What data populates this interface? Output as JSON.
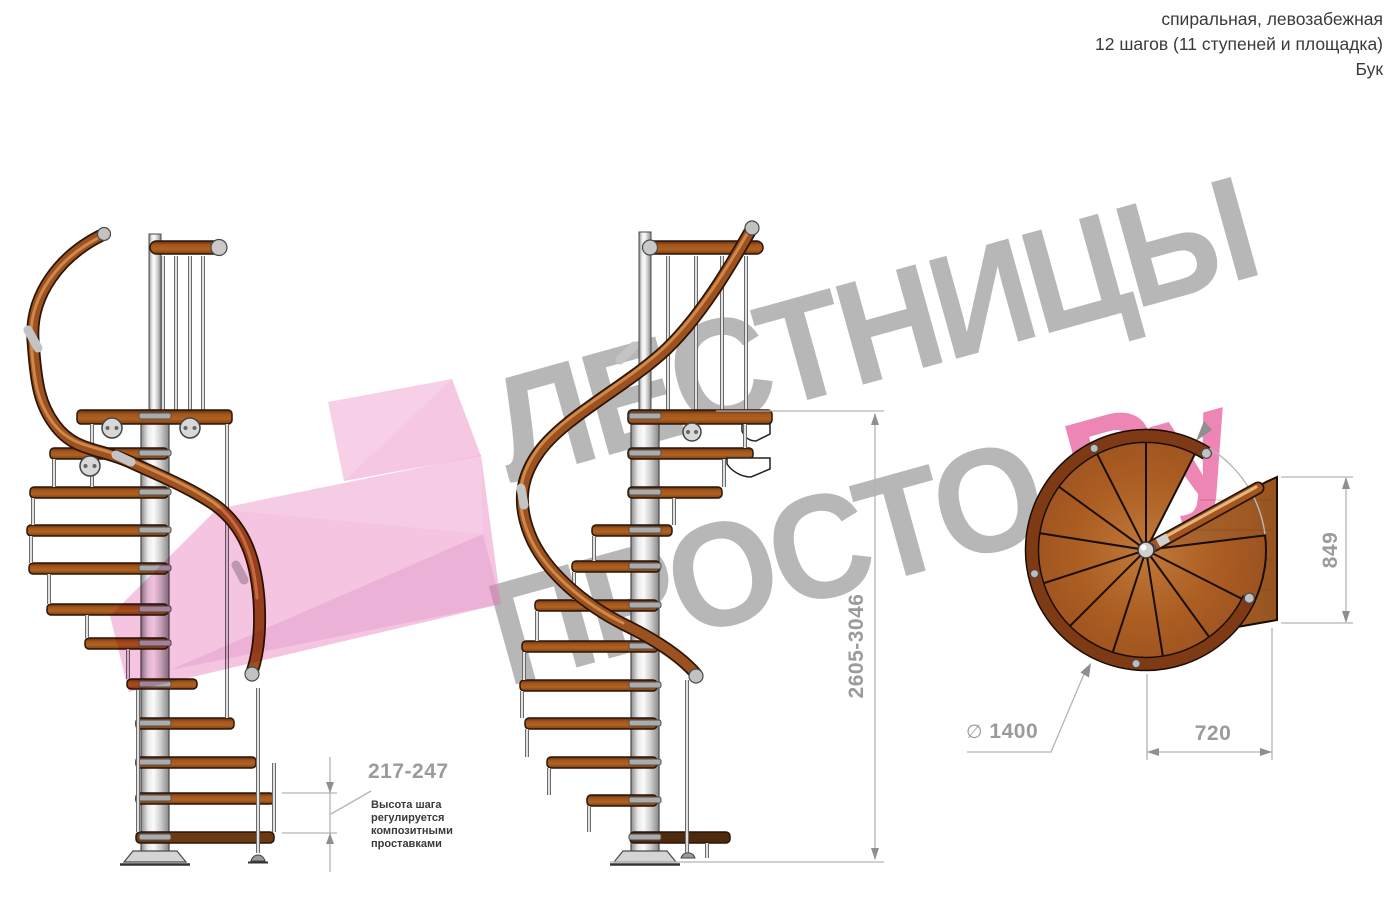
{
  "header": {
    "lines": [
      "спиральная, левозабежная",
      "12 шагов (11 ступеней и площадка)",
      "Бук"
    ]
  },
  "watermark": {
    "line1": "ЛЕСТНИЦЫ",
    "line2_gray": "ПРОСТО",
    "line2_pink": ".Ру",
    "gray_color": "#b7b7b7",
    "pink_color": "#ee86b5",
    "arrow_color": "#eb8ac4"
  },
  "dimensions": {
    "step_height": {
      "value": "217-247",
      "note": "Высота шага\nрегулируется\nкомпозитными\nпроставками"
    },
    "total_height": {
      "value": "2605-3046"
    },
    "landing_depth": {
      "value": "849"
    },
    "landing_width": {
      "value": "720"
    },
    "diameter": {
      "symbol": "∅",
      "value": "1400"
    }
  },
  "colors": {
    "wood_mid": "#a4561e",
    "wood_dark_edge": "#2a1506",
    "handrail_dark": "#7e3a14",
    "metal_light": "#d9d9d9",
    "dimension_line": "#b3b3b3",
    "dimension_label": "#9b9b9b",
    "text_dark": "#3a3a3a"
  }
}
